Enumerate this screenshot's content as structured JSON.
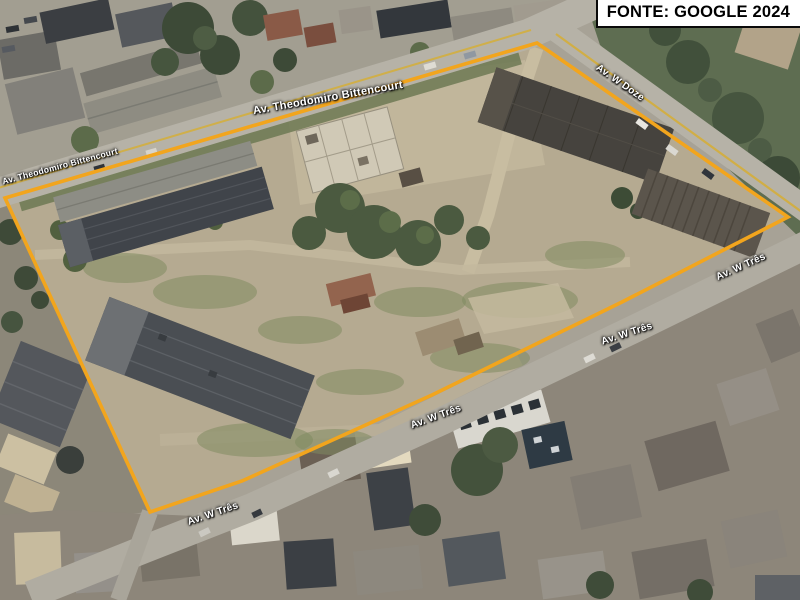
{
  "source_badge": {
    "text": "FONTE: GOOGLE 2024"
  },
  "map": {
    "boundary": {
      "name": "property-boundary",
      "color": "#F2A51D"
    },
    "labels": {
      "theodomiro_top": "Av. Theodomiro Bittencourt",
      "theodomiro_left": "Av. Theodomiro Bittencourt",
      "w_doze": "Av. W Doze",
      "w_tres_right": "Av. W Três",
      "w_tres_mid": "Av. W Três",
      "w_tres_center": "Av. W Três",
      "w_tres_bottom": "Av. W Três"
    }
  }
}
